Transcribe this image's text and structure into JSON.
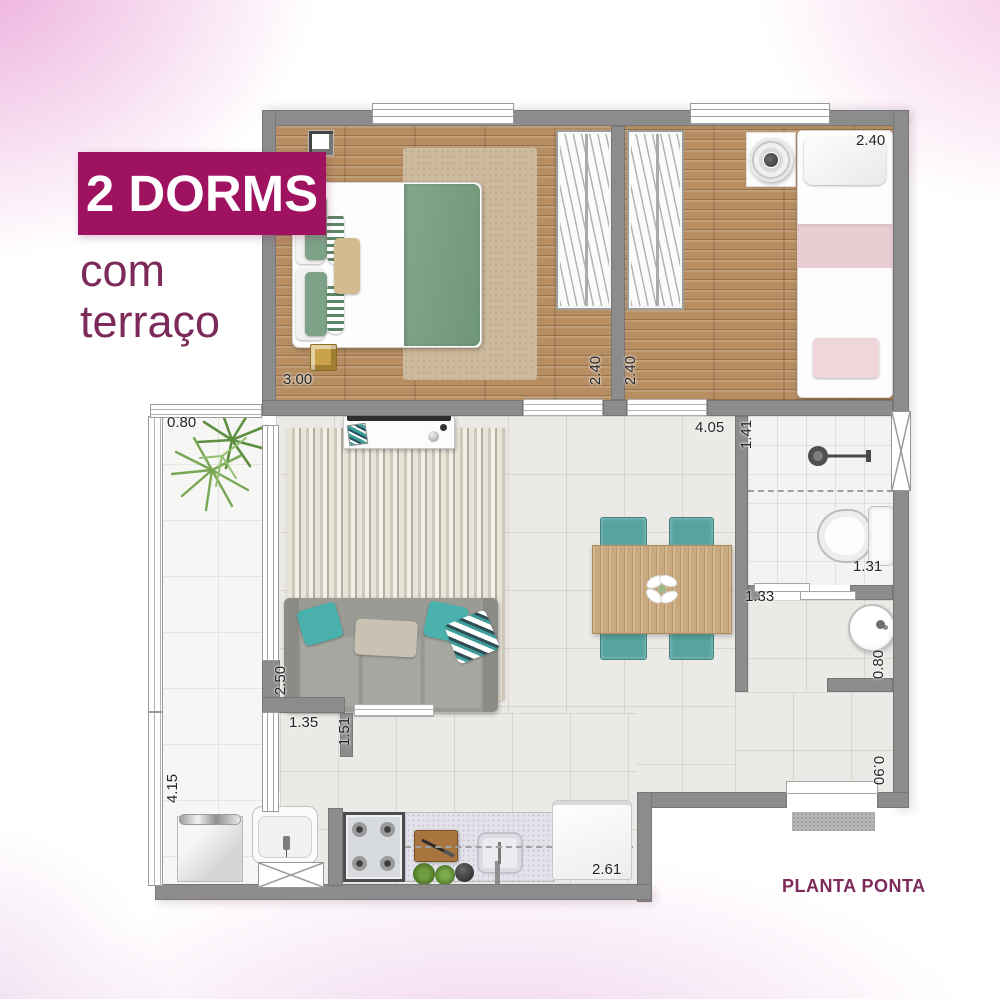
{
  "title": {
    "banner": "2 DORMS",
    "subtitle_line1": "com",
    "subtitle_line2": "terraço"
  },
  "plan_label": "PLANTA PONTA",
  "measurements": {
    "terrace_width": "0.80",
    "bedroom1_width": "3.00",
    "bedroom1_depth": "2.40",
    "bedroom2_depth": "2.40",
    "bedroom2_width": "2.40",
    "living_width": "4.05",
    "bath_width": "1.41",
    "bath_length": "1.31",
    "hall_width": "1.33",
    "hall_sink_width": "0.80",
    "living_wall": "2.50",
    "wall_segment": "1.35",
    "opening_width": "1.51",
    "terrace_length": "4.15",
    "entry_width": "0.90",
    "kitchen_run": "2.61"
  },
  "colors": {
    "accent": "#9e1260",
    "plum": "#7c2a5a",
    "wall": "#8c8c8c",
    "wood": "#b68e62",
    "tile": "#eceae6",
    "teal": "#57a39f",
    "green": "#7da287",
    "pink": "#e8cdd3"
  }
}
